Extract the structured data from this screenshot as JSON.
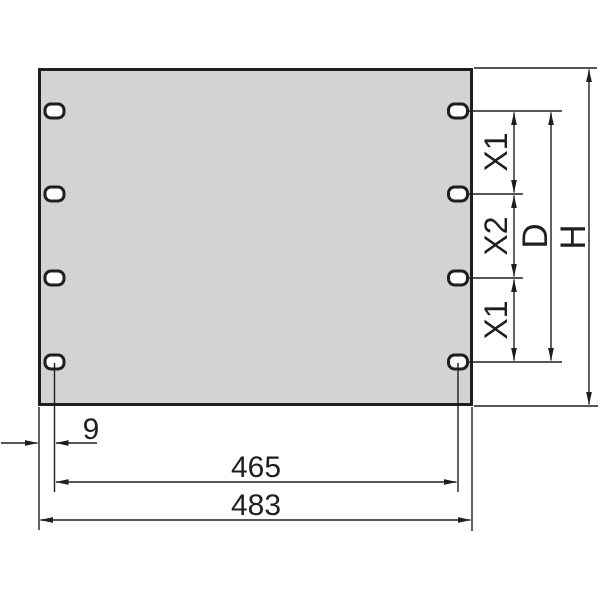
{
  "drawing": {
    "colors": {
      "page_bg": "#ffffff",
      "panel_fill": "#d3d3d3",
      "slot_fill": "#ffffff",
      "line": "#1f1f1f"
    },
    "vertical_dims": {
      "x1_top": "X1",
      "x2": "X2",
      "x1_bottom": "X1",
      "d": "D",
      "h": "H"
    },
    "horizontal_dims": {
      "edge_to_hole": "9",
      "hole_span": "465",
      "overall_width": "483"
    }
  }
}
